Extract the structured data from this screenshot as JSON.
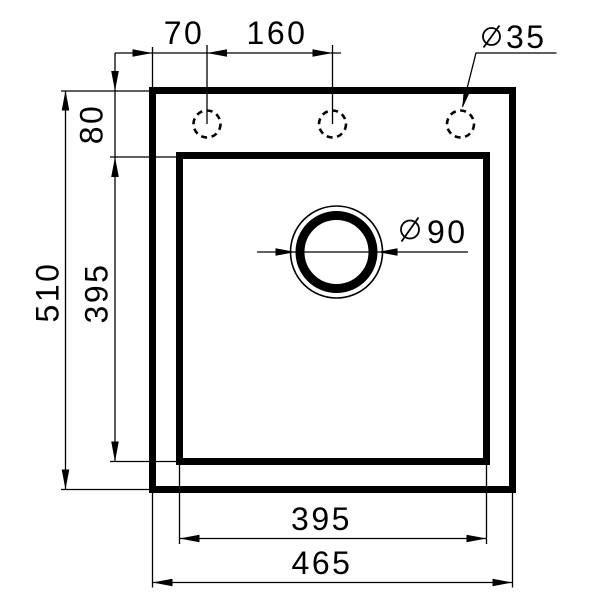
{
  "drawing": {
    "type": "technical-dimension-drawing",
    "subject": "sink-top-view",
    "background_color": "#ffffff",
    "line_color": "#000000",
    "dimensions": {
      "faucet_hole_offset": {
        "value": "70"
      },
      "faucet_hole_spacing": {
        "value": "160"
      },
      "faucet_hole_diameter": {
        "symbol": "⌀",
        "value": "35"
      },
      "rim_to_bowl": {
        "value": "80"
      },
      "overall_depth": {
        "value": "510"
      },
      "bowl_depth": {
        "value": "395"
      },
      "drain_diameter": {
        "symbol": "⌀",
        "value": "90"
      },
      "bowl_width": {
        "value": "395"
      },
      "overall_width": {
        "value": "465"
      }
    }
  }
}
